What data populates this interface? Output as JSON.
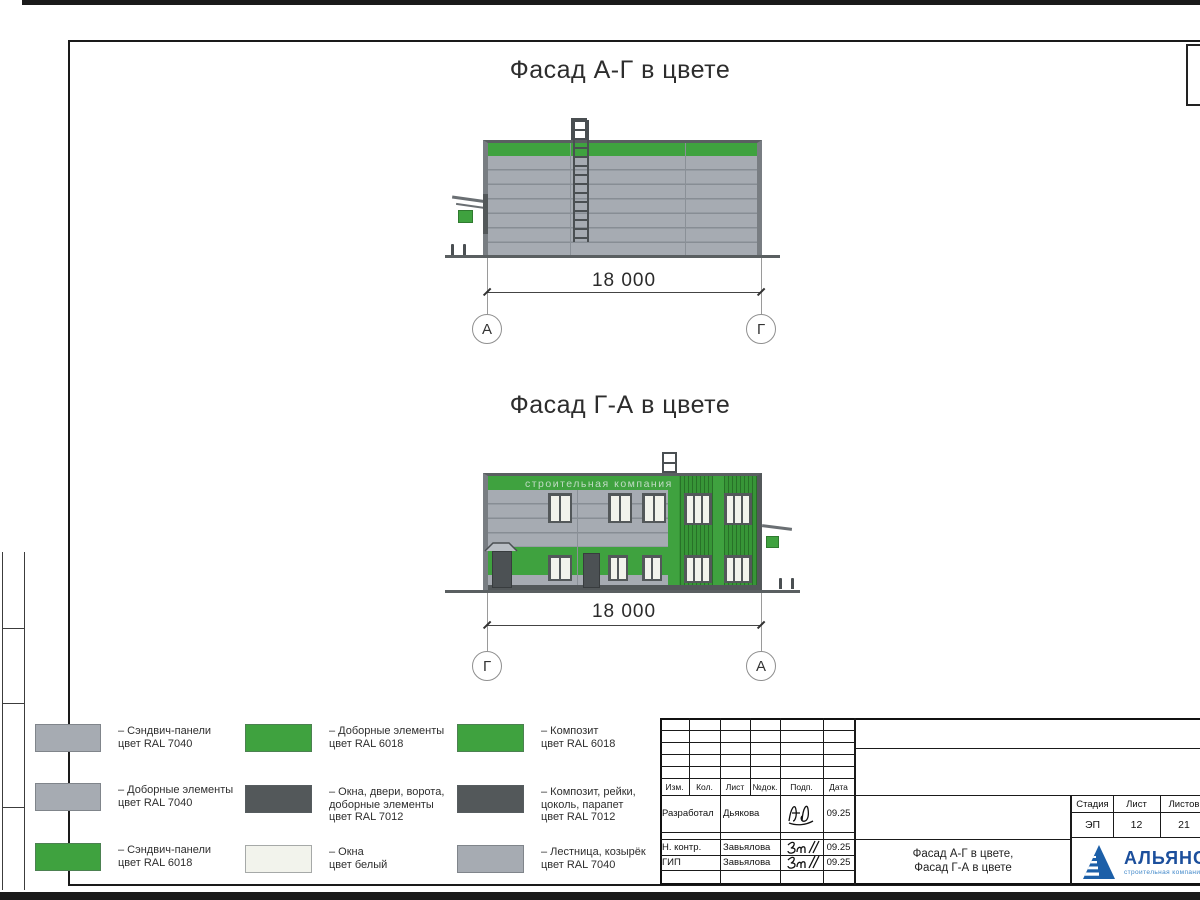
{
  "palette": {
    "gray_ral7040": "#a6abb2",
    "green_ral6018": "#3fa23f",
    "dark_ral7012": "#53585a",
    "window_white": "#f2f3ec"
  },
  "facade1": {
    "title": "Фасад А-Г в цвете",
    "dimension": "18 000",
    "axis_left": "А",
    "axis_right": "Г"
  },
  "facade2": {
    "title": "Фасад Г-А в цвете",
    "dimension": "18 000",
    "axis_left": "Г",
    "axis_right": "А",
    "watermark": "строительная компания"
  },
  "legend": [
    {
      "color": "#a6abb2",
      "label": "– Сэндвич-панели\nцвет RAL 7040"
    },
    {
      "color": "#a6abb2",
      "label": "– Доборные элементы\nцвет RAL 7040"
    },
    {
      "color": "#3fa23f",
      "label": "– Сэндвич-панели\nцвет RAL 6018"
    },
    {
      "color": "#3fa23f",
      "label": "– Доборные элементы\nцвет RAL 6018"
    },
    {
      "color": "#53585a",
      "label": "– Окна, двери, ворота,\nдоборные элементы\nцвет RAL 7012"
    },
    {
      "color": "#f2f3ec",
      "label": "– Окна\nцвет белый"
    },
    {
      "color": "#3fa23f",
      "label": "– Композит\nцвет RAL 6018"
    },
    {
      "color": "#53585a",
      "label": "– Композит, рейки,\nцоколь, парапет\nцвет RAL 7012"
    },
    {
      "color": "#a6abb2",
      "label": "– Лестница, козырёк\nцвет RAL 7040"
    }
  ],
  "stamp": {
    "header_cols": [
      "Изм.",
      "Кол.",
      "Лист",
      "№док.",
      "Подп.",
      "Дата"
    ],
    "rows": [
      {
        "role": "Разработал",
        "name": "Дьякова",
        "date": "09.25"
      },
      {
        "role": "Н. контр.",
        "name": "Завьялова",
        "date": "09.25"
      },
      {
        "role": "ГИП",
        "name": "Завьялова",
        "date": "09.25"
      }
    ],
    "stage_label": "Стадия",
    "sheet_label": "Лист",
    "sheets_label": "Листов",
    "stage": "ЭП",
    "sheet_no": "12",
    "sheets_total": "21",
    "doc_title": "Фасад А-Г в цвете,\nФасад Г-А в цвете",
    "company": "АЛЬЯНС",
    "company_sub": "строительная компания"
  }
}
